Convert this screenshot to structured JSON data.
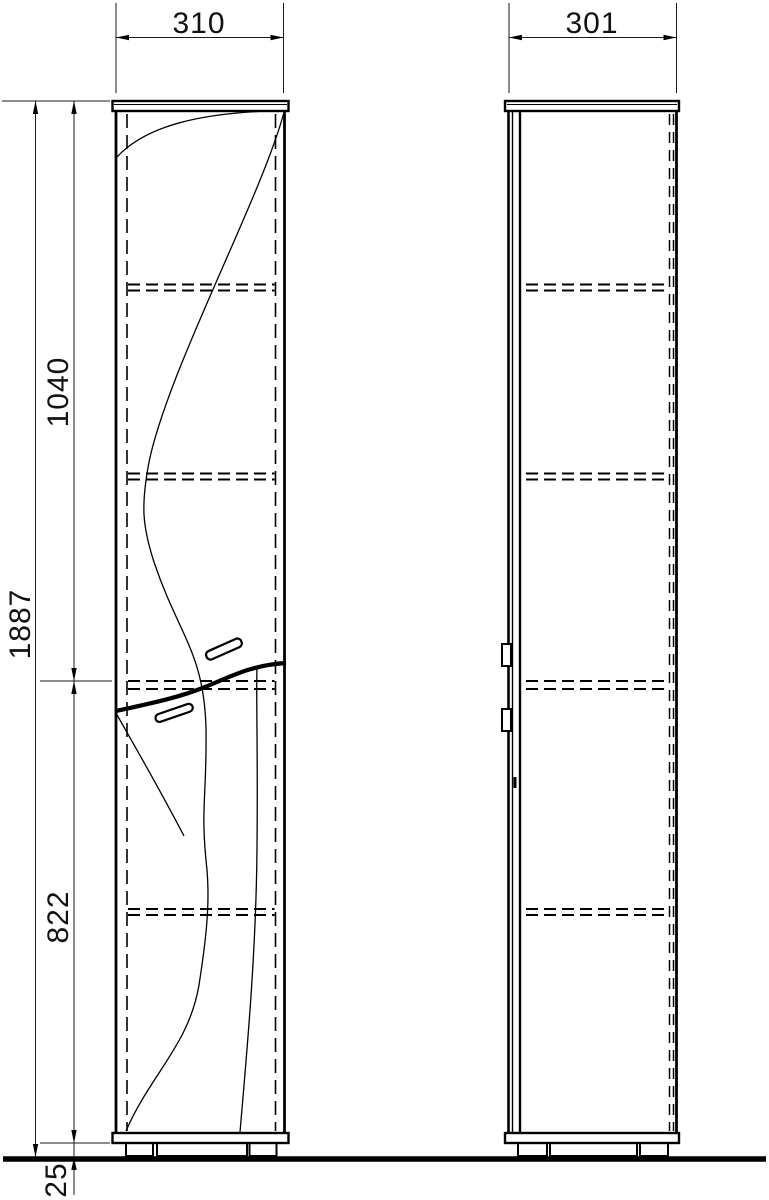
{
  "views": {
    "front": {
      "width_label": "310",
      "height_total_label": "1887",
      "height_upper_label": "1040",
      "height_lower_label": "822",
      "base_height_label": "25"
    },
    "side": {
      "depth_label": "301"
    }
  },
  "colors": {
    "line": "#000000",
    "thin_line": "#1a1a1a",
    "background": "#ffffff"
  }
}
